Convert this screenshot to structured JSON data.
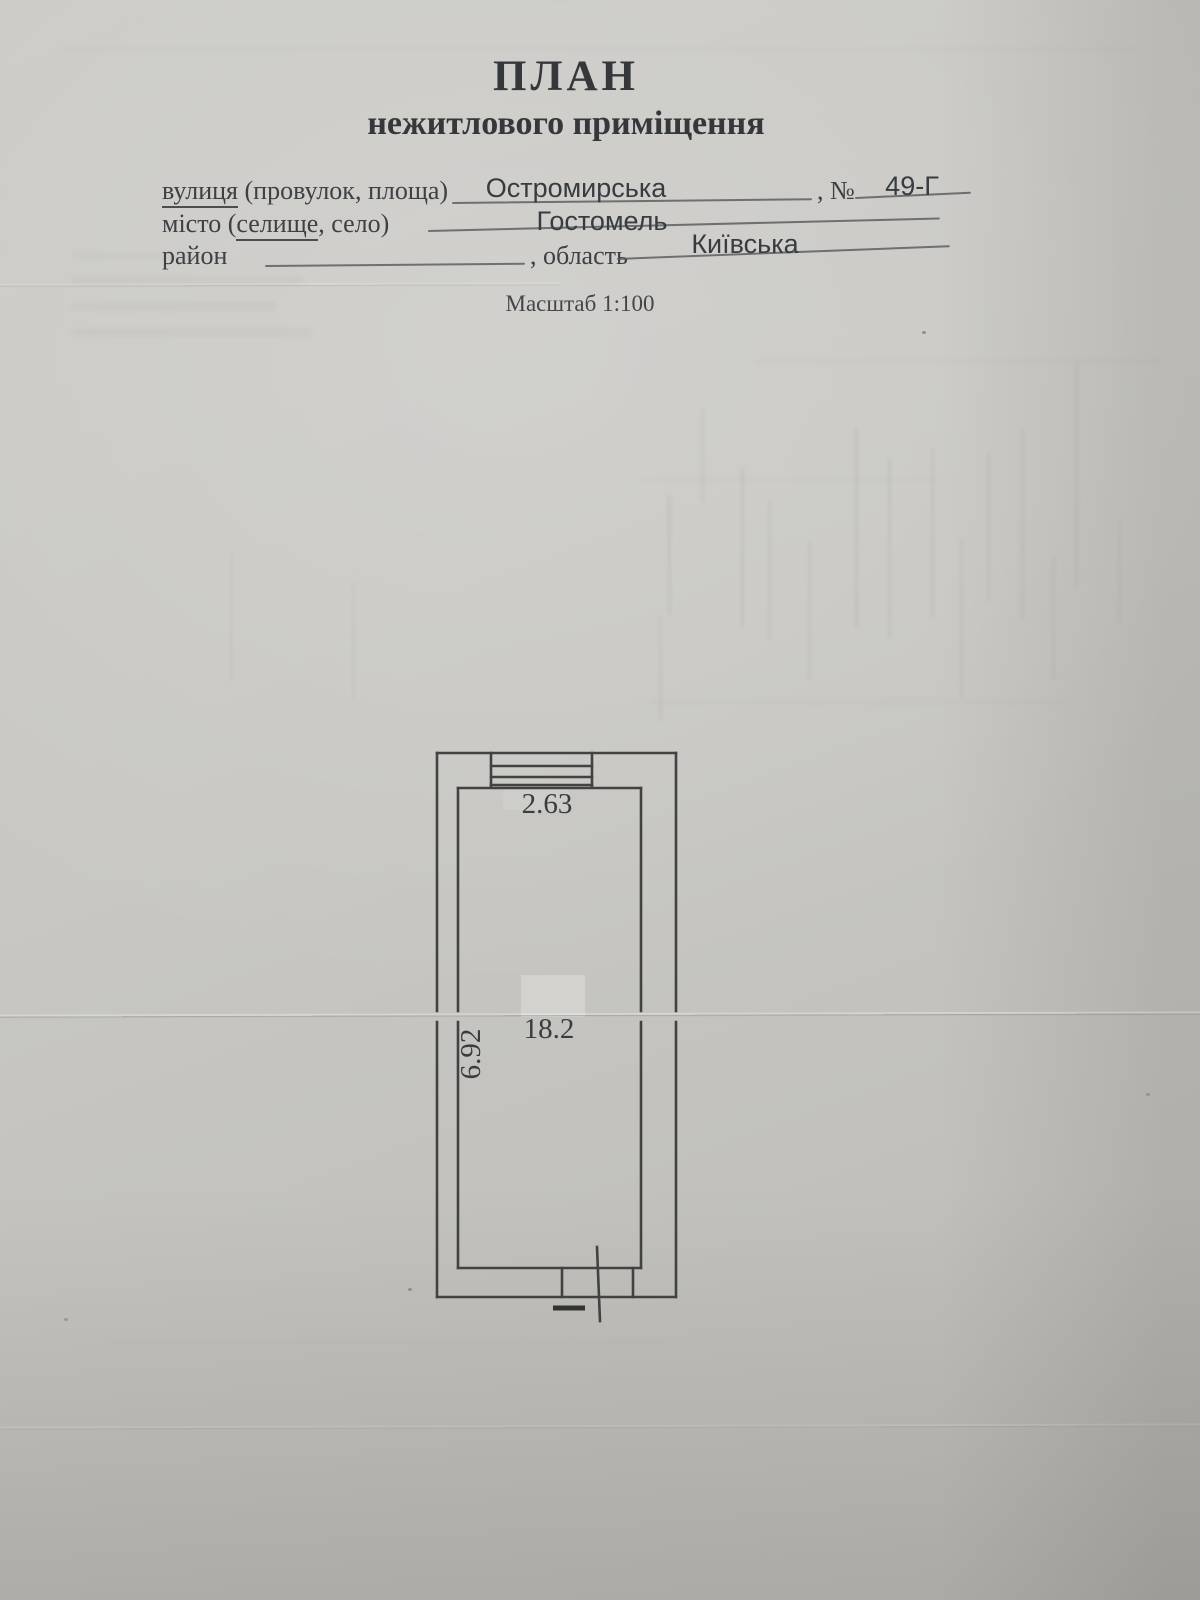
{
  "title": {
    "line1": "ПЛАН",
    "line2": "нежитлового приміщення"
  },
  "form": {
    "street": {
      "label_underlined": "вулиця",
      "label_rest": " (провулок, площа)",
      "value": "Остромирська"
    },
    "number": {
      "label": ", №",
      "value": "49-Г"
    },
    "city": {
      "label_prefix": "місто (",
      "label_underlined": "селище",
      "label_suffix": ", село)",
      "value": "Гостомель"
    },
    "district": {
      "label": "район",
      "value": ""
    },
    "region": {
      "label": ", область",
      "value": "Київська"
    }
  },
  "scale": {
    "label": "Масштаб 1:100"
  },
  "plan": {
    "type": "floor-plan",
    "room": {
      "width_m": "2.63",
      "depth_m": "6.92",
      "area_m2": "18.2"
    }
  },
  "colors": {
    "paper": "#c8c7c3",
    "ink": "#3c3e40",
    "drawing_line": "#424340"
  }
}
